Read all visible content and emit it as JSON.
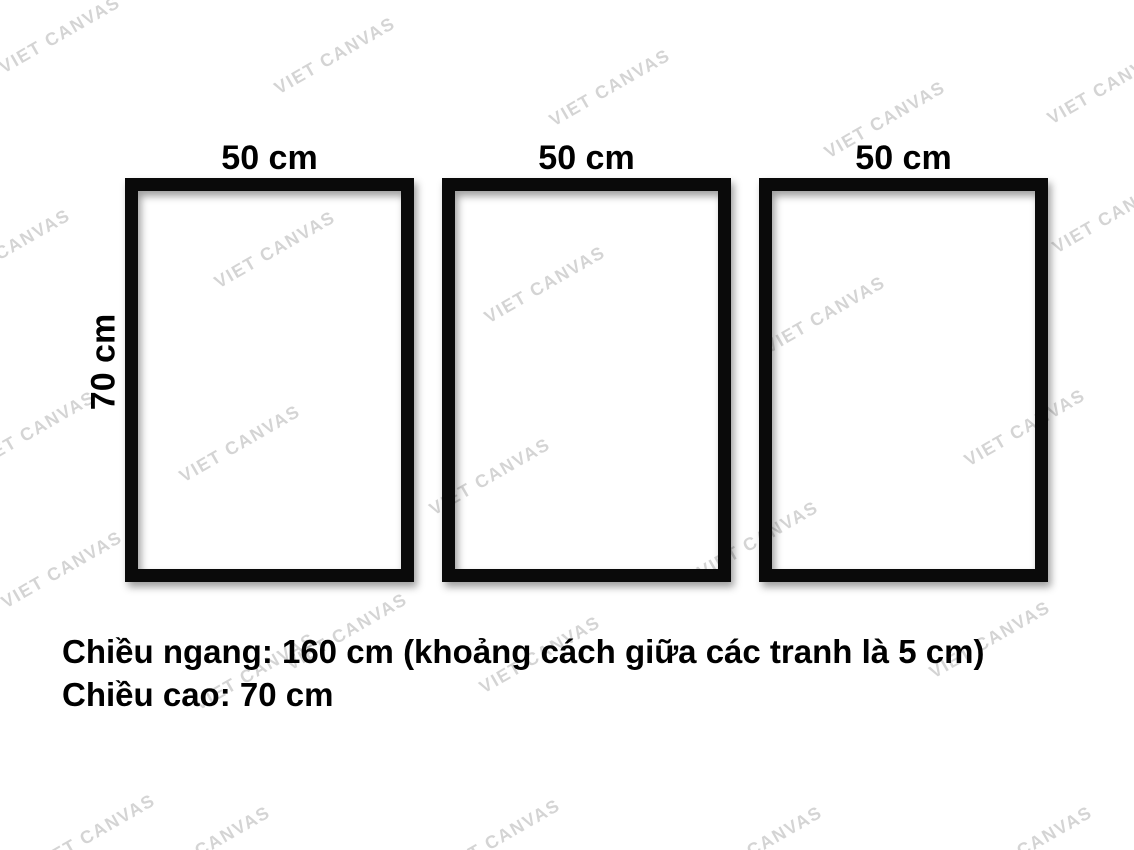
{
  "page": {
    "background_color": "#ffffff",
    "frame_border_color": "#0a0a0a"
  },
  "watermark": {
    "text": "VIET CANVAS",
    "color": "rgba(0,0,0,0.17)",
    "angle_deg": -30,
    "positions": [
      [
        60,
        35
      ],
      [
        335,
        56
      ],
      [
        610,
        88
      ],
      [
        885,
        120
      ],
      [
        1108,
        86
      ],
      [
        10,
        248
      ],
      [
        275,
        250
      ],
      [
        545,
        285
      ],
      [
        825,
        315
      ],
      [
        1113,
        215
      ],
      [
        35,
        430
      ],
      [
        240,
        444
      ],
      [
        490,
        477
      ],
      [
        758,
        540
      ],
      [
        1025,
        428
      ],
      [
        62,
        570
      ],
      [
        347,
        632
      ],
      [
        540,
        655
      ],
      [
        990,
        640
      ],
      [
        95,
        833
      ],
      [
        255,
        672
      ],
      [
        500,
        838
      ],
      [
        762,
        845
      ],
      [
        1032,
        845
      ],
      [
        210,
        845
      ]
    ]
  },
  "frames": {
    "height_label": "70 cm",
    "items": [
      {
        "width_label": "50 cm"
      },
      {
        "width_label": "50 cm"
      },
      {
        "width_label": "50 cm"
      }
    ]
  },
  "caption": {
    "line1": "Chiều ngang: 160 cm (khoảng cách giữa các tranh là 5 cm)",
    "line2": "Chiều cao: 70 cm"
  }
}
